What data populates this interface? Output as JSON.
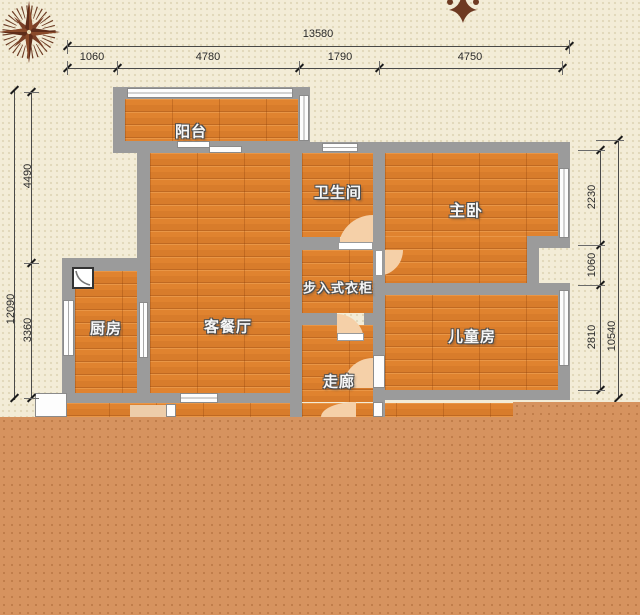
{
  "plan": {
    "rooms": {
      "balcony": {
        "label": "阳台"
      },
      "bathroom": {
        "label": "卫生间"
      },
      "master": {
        "label": "主卧"
      },
      "closet": {
        "label": "步入式衣柜"
      },
      "kitchen": {
        "label": "厨房"
      },
      "living": {
        "label": "客餐厅"
      },
      "children": {
        "label": "儿童房"
      },
      "corridor": {
        "label": "走廊"
      }
    },
    "dimensions": {
      "top": {
        "total": "13580",
        "segments": [
          "1060",
          "4780",
          "1790",
          "4750"
        ]
      },
      "left": {
        "total": "12090",
        "segments": [
          "4490",
          "3360"
        ]
      },
      "right": {
        "total": "10540",
        "segments": [
          "2230",
          "1060",
          "2810"
        ]
      }
    },
    "colors": {
      "background": "#f3ecd7",
      "wall": "#9b9b9b",
      "floor": "#e0832f",
      "overlay": "#d6935f",
      "door_arc": "#f5d0a8",
      "compass": "#5f2d1a"
    },
    "icons": {
      "compass": "compass-rose",
      "ornament": "floral-ornament",
      "corner_fixture": "corner-basin"
    }
  }
}
